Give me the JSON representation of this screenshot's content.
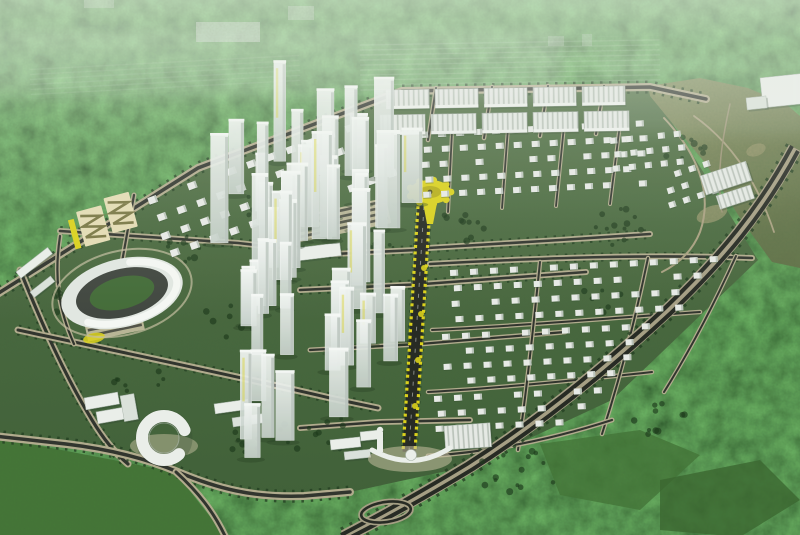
{
  "meta": {
    "description": "Aerial 3D master-plan rendering of a new urban township: central glass high-rise towers, villa grids, rowhouse blocks, oval stadium, yellow tree-lined boulevard, perimeter highway, surrounded by forest and fields",
    "width": 800,
    "height": 535
  },
  "colors": {
    "haze_top": "#93a28c",
    "forest_mid": "#34562c",
    "forest_dark": "#24441f",
    "field": "#3f7231",
    "field2": "#356329",
    "lawn_hi": "#4a6a3e",
    "lawn_lo": "#3c5c33",
    "hills_hi": "#878c5c",
    "hills_lo": "#66724616",
    "hills": "#6e7849",
    "sand": "#c2b083",
    "road_core": "#2b2e28",
    "road_casing": "#b2aa8c",
    "highway_core": "#20231d",
    "highway_casing": "#a59d82",
    "tree": "#1d3a1b",
    "tree2": "#163214",
    "white": "#eef1ed",
    "white_dim": "#dde3dd",
    "shade": "#aab5ac",
    "glass_hi": "#f6f9f7",
    "glass_lo": "#c8d2cc",
    "yellow": "#ddd215",
    "yellow_dark": "#b8ae10",
    "cream": "#e7deb5",
    "zigzag": "#77743f",
    "apron": "#c6bfa0",
    "track": "#3c413b",
    "infield": "#3f6833",
    "distant": "#cfd8cf",
    "haze": "#e9efe5"
  },
  "scene": {
    "dev_polygon": "-6,296 198,168 402,91 650,87 664,110 702,170 758,260 612,400 470,466 350,492 306,497 250,497 178,472 150,460 66,444 -6,436",
    "field_bl": "-6,437 175,472 226,537 -6,537",
    "bright_patch_1": "540,444 640,430 700,455 640,510 560,495",
    "bright_patch_2": "660,480 760,460 800,500 740,537 660,530",
    "hills_polygon": "648,86 700,78 748,88 786,104 800,116 800,268 772,262 740,218 706,164 668,118 650,96",
    "roads": [
      {
        "name": "top-boundary-road",
        "d": "M -6 296 L 198 168 L 402 91 L 650 87 L 706 99",
        "cw": 8,
        "kw": 3.5,
        "tree": 13
      },
      {
        "name": "left-boundary-road",
        "d": "M 20 270 C 42 324 64 374 92 420 C 104 440 116 454 128 464",
        "cw": 7,
        "kw": 3.2,
        "tree": 11
      },
      {
        "name": "bottom-road",
        "d": "M -6 436 L 66 444 C 116 450 150 460 178 472 C 216 488 252 498 304 496 L 350 492",
        "cw": 8,
        "kw": 3.5,
        "tree": 13
      },
      {
        "name": "bottom-branch-road",
        "d": "M 176 472 C 198 492 214 512 226 538",
        "cw": 7,
        "kw": 3
      },
      {
        "name": "center-road",
        "d": "M 18 330 C 120 352 228 374 330 398 L 378 408",
        "cw": 7,
        "kw": 3,
        "tree": 11
      },
      {
        "name": "north-cross-road",
        "d": "M 60 231 L 238 243 L 334 254 L 416 250",
        "cw": 6,
        "kw": 2.6,
        "tree": 10
      },
      {
        "name": "park-road",
        "d": "M 134 195 L 122 262",
        "cw": 5,
        "kw": 2.2
      },
      {
        "name": "stadium-road",
        "d": "M 60 236 C 54 276 58 308 74 344",
        "cw": 5,
        "kw": 2.2
      },
      {
        "name": "cross-street-1",
        "d": "M 428 248 L 560 240 L 650 234",
        "cw": 6,
        "kw": 2.6,
        "tree": 10
      },
      {
        "name": "cross-street-2",
        "d": "M 300 290 L 424 284 L 586 272",
        "cw": 6,
        "kw": 2.6,
        "tree": 10
      },
      {
        "name": "cross-street-3",
        "d": "M 310 350 L 420 344 L 565 332",
        "cw": 5,
        "kw": 2.2
      },
      {
        "name": "south-cross-road",
        "d": "M 300 428 L 380 422 L 470 420",
        "cw": 6,
        "kw": 2.6
      },
      {
        "name": "estate-c-top-street",
        "d": "M 430 264 C 540 258 650 254 752 258",
        "cw": 6,
        "kw": 2.6,
        "tree": 9
      },
      {
        "name": "estate-b-street-1",
        "d": "M 452 132 L 448 212",
        "cw": 4,
        "kw": 1.8
      },
      {
        "name": "estate-b-street-2",
        "d": "M 508 128 L 502 208",
        "cw": 4,
        "kw": 1.8
      },
      {
        "name": "estate-b-street-3",
        "d": "M 564 126 L 556 206",
        "cw": 4,
        "kw": 1.8
      },
      {
        "name": "estate-b-street-4",
        "d": "M 620 124 L 610 204",
        "cw": 4,
        "kw": 1.8
      },
      {
        "name": "estate-c-street-h1",
        "d": "M 432 330 C 520 326 610 318 700 312",
        "cw": 4.5,
        "kw": 2
      },
      {
        "name": "estate-c-street-h2",
        "d": "M 428 392 C 500 388 580 380 652 372",
        "cw": 4.5,
        "kw": 2
      },
      {
        "name": "estate-c-street-v1",
        "d": "M 540 262 C 534 320 528 380 518 450",
        "cw": 4.5,
        "kw": 2
      },
      {
        "name": "estate-c-street-v2",
        "d": "M 648 258 C 636 316 622 372 602 434",
        "cw": 4.5,
        "kw": 2
      },
      {
        "name": "estate-c-street-v3",
        "d": "M 736 256 C 716 300 694 344 664 392",
        "cw": 4.5,
        "kw": 2
      },
      {
        "name": "estate-c-bottom-street",
        "d": "M 428 456 C 490 452 550 440 612 420",
        "cw": 5,
        "kw": 2.2
      },
      {
        "name": "rowhouse-cross-1",
        "d": "M 436 88 L 428 140",
        "cw": 4.5,
        "kw": 2
      },
      {
        "name": "rowhouse-cross-2",
        "d": "M 492 87 L 484 138",
        "cw": 4.5,
        "kw": 2
      },
      {
        "name": "rowhouse-cross-3",
        "d": "M 548 86 L 540 136",
        "cw": 4.5,
        "kw": 2
      },
      {
        "name": "rowhouse-cross-4",
        "d": "M 604 86 L 596 134",
        "cw": 4.5,
        "kw": 2
      },
      {
        "name": "hill-path-1",
        "d": "M 664 118 C 696 152 714 192 700 232 C 692 252 678 264 662 272",
        "cw": 0,
        "kw": 2,
        "core": "#a89f7e"
      },
      {
        "name": "hill-path-2",
        "d": "M 694 116 C 728 140 756 178 774 232",
        "cw": 0,
        "kw": 1.8,
        "core": "#a89f7e"
      },
      {
        "name": "hill-path-3",
        "d": "M 730 104 C 722 140 716 176 722 212",
        "cw": 0,
        "kw": 1.5,
        "core": "#9a9172"
      }
    ],
    "highway": {
      "name": "perimeter-highway",
      "d": "M 795 148 C 762 210 722 258 668 310 C 612 362 542 420 470 466 C 424 494 384 516 344 537",
      "cores": [
        "M 792 146 C 759 208 719 256 665 308 C 609 360 539 418 467 464 C 421 492 381 514 341 535",
        "M 798 151 C 765 213 725 261 671 313 C 615 365 545 423 473 469 C 427 497 387 519 347 539"
      ],
      "casing_w": 14,
      "tree_w": 20
    },
    "avenue": {
      "name": "grand-boulevard",
      "base": "M 424 206 L 409 452",
      "yellow_left": "M 418 206 L 403 452",
      "yellow_right": "M 430 206 L 415 452",
      "roundabout": {
        "cx": 430,
        "cy": 192,
        "rx": 21,
        "ry": 12
      },
      "trunk": "423,203 437,203 433,224 427,224",
      "dots": [
        [
          424,
          268
        ],
        [
          421,
          314
        ],
        [
          418,
          360
        ],
        [
          415,
          406
        ]
      ]
    },
    "villa_estates": [
      {
        "name": "villa-grid-northwest",
        "x": 148,
        "y": 200,
        "rot": -20,
        "rows": 4,
        "cols": 12,
        "dx": 21,
        "dy": 19,
        "w": 9,
        "h": 7
      },
      {
        "name": "villa-grid-north",
        "x": 420,
        "y": 134,
        "rot": -3,
        "rows": 5,
        "cols": 13,
        "dx": 18,
        "dy": 15,
        "w": 8,
        "h": 6
      },
      {
        "name": "villa-grid-east-1",
        "x": 450,
        "y": 272,
        "rot": -3,
        "rows": 4,
        "cols": 15,
        "dx": 20,
        "dy": 15.5,
        "w": 8,
        "h": 6,
        "cut": true
      },
      {
        "name": "villa-grid-east-2",
        "x": 442,
        "y": 336,
        "rot": -3,
        "rows": 4,
        "cols": 12,
        "dx": 20,
        "dy": 15,
        "w": 8,
        "h": 6,
        "cut": true
      },
      {
        "name": "villa-grid-east-3",
        "x": 434,
        "y": 398,
        "rot": -3,
        "rows": 3,
        "cols": 9,
        "dx": 20,
        "dy": 15,
        "w": 8,
        "h": 6,
        "cut": true
      },
      {
        "name": "villa-grid-mid-east",
        "x": 610,
        "y": 140,
        "rot": -6,
        "rows": 3,
        "cols": 5,
        "dx": 16,
        "dy": 14,
        "w": 7,
        "h": 6
      },
      {
        "name": "villa-grid-far-east",
        "x": 660,
        "y": 178,
        "rot": -18,
        "rows": 3,
        "cols": 4,
        "dx": 15,
        "dy": 14,
        "w": 7,
        "h": 6
      }
    ],
    "rowhouse_bands": [
      {
        "name": "rowhouse-band-1",
        "x": 386,
        "y": 90,
        "rot": -1,
        "blocks": 5,
        "bw": 43,
        "bh": 19,
        "gap": 6
      },
      {
        "name": "rowhouse-band-2",
        "x": 380,
        "y": 115,
        "rot": -1,
        "blocks": 5,
        "bw": 45,
        "bh": 20,
        "gap": 6
      }
    ],
    "tower_clusters": [
      {
        "name": "tower-cluster-north",
        "x0": 190,
        "x1": 408,
        "y0": 158,
        "y1": 288,
        "n": 30,
        "hmin": 52,
        "hmax": 108,
        "wmin": 11,
        "wmax": 21,
        "seed": 11
      },
      {
        "name": "tower-cluster-south",
        "x0": 196,
        "x1": 414,
        "y0": 300,
        "y1": 458,
        "n": 24,
        "hmin": 44,
        "hmax": 92,
        "wmin": 10,
        "wmax": 19,
        "seed": 29
      }
    ],
    "landmark_towers": [
      {
        "x": 377,
        "y": 228,
        "w": 23,
        "h": 96
      },
      {
        "x": 352,
        "y": 282,
        "w": 18,
        "h": 92
      },
      {
        "x": 252,
        "y": 270,
        "w": 16,
        "h": 95
      }
    ],
    "misc_buildings": [
      {
        "name": "office-slab",
        "x": 84,
        "y": 398,
        "w": 34,
        "h": 12,
        "rot": -10,
        "fill": "white"
      },
      {
        "name": "office-slab",
        "x": 96,
        "y": 412,
        "w": 40,
        "h": 12,
        "rot": -10,
        "fill": "white"
      },
      {
        "name": "office-slab",
        "x": 120,
        "y": 396,
        "w": 14,
        "h": 26,
        "rot": -10,
        "fill": "dim"
      },
      {
        "name": "office-slab",
        "x": 214,
        "y": 404,
        "w": 34,
        "h": 10,
        "rot": -8,
        "fill": "white"
      },
      {
        "name": "office-slab",
        "x": 232,
        "y": 418,
        "w": 30,
        "h": 9,
        "rot": -8,
        "fill": "dim"
      },
      {
        "name": "plaza-west-building",
        "x": 330,
        "y": 440,
        "w": 30,
        "h": 10,
        "rot": -6,
        "fill": "white"
      },
      {
        "name": "plaza-west-building",
        "x": 344,
        "y": 452,
        "w": 26,
        "h": 8,
        "rot": -6,
        "fill": "dim"
      },
      {
        "name": "plaza-west-building",
        "x": 360,
        "y": 432,
        "w": 22,
        "h": 9,
        "rot": -6,
        "fill": "white"
      },
      {
        "name": "plaza-east-hall",
        "x": 444,
        "y": 426,
        "w": 46,
        "h": 24,
        "rot": -4,
        "fill": "ridge"
      },
      {
        "name": "east-campus-hall",
        "x": 700,
        "y": 176,
        "w": 48,
        "h": 20,
        "rot": -18,
        "fill": "ridge"
      },
      {
        "name": "east-campus-hall",
        "x": 716,
        "y": 196,
        "w": 36,
        "h": 14,
        "rot": -18,
        "fill": "ridge"
      },
      {
        "name": "northeast-hall",
        "x": 760,
        "y": 78,
        "w": 46,
        "h": 30,
        "rot": -6,
        "fill": "white"
      },
      {
        "name": "northeast-hall",
        "x": 746,
        "y": 98,
        "w": 20,
        "h": 12,
        "rot": -6,
        "fill": "dim"
      },
      {
        "name": "west-strip-building",
        "x": 16,
        "y": 272,
        "w": 40,
        "h": 8,
        "rot": -38,
        "fill": "white"
      },
      {
        "name": "west-strip-building",
        "x": 30,
        "y": 292,
        "w": 26,
        "h": 7,
        "rot": -38,
        "fill": "dim"
      },
      {
        "name": "curved-podium",
        "x": 296,
        "y": 248,
        "w": 44,
        "h": 13,
        "rot": -7,
        "fill": "white"
      }
    ],
    "distant_buildings": [
      {
        "x": 196,
        "y": 22,
        "w": 64,
        "h": 20,
        "op": 0.55
      },
      {
        "x": 288,
        "y": 6,
        "w": 26,
        "h": 14,
        "op": 0.4
      },
      {
        "x": 84,
        "y": 0,
        "w": 30,
        "h": 8,
        "op": 0.35
      },
      {
        "x": 548,
        "y": 36,
        "w": 16,
        "h": 10,
        "op": 0.3
      },
      {
        "x": 582,
        "y": 34,
        "w": 10,
        "h": 12,
        "op": 0.3
      }
    ],
    "stadium": {
      "name": "stadium",
      "cx": 122,
      "cy": 293,
      "rot": -14,
      "orx": 62,
      "ory": 34,
      "trx": 47,
      "try": 24,
      "irx": 33,
      "iry": 16
    },
    "parking_lots": [
      {
        "name": "parking-lot-central",
        "x": 290,
        "y": 218,
        "w": 98,
        "h": 26,
        "rot": -12,
        "rows": 4
      },
      {
        "name": "parking-lot-stadium",
        "x": 84,
        "y": 322,
        "w": 58,
        "h": 20,
        "rot": -12,
        "rows": 3
      }
    ],
    "zigzag_park": {
      "name": "zigzag-garden",
      "x": 76,
      "y": 212,
      "rot": -15
    },
    "yellow_oval": {
      "cx": 94,
      "cy": 338,
      "rx": 11,
      "ry": 5,
      "rot": -12
    },
    "c_building": {
      "name": "horseshoe-building",
      "cx": 164,
      "cy": 438,
      "r": 22
    },
    "plaza": {
      "name": "gateway-plaza",
      "arc": "M 372 450 Q 412 472 450 448",
      "dome": [
        411,
        455
      ],
      "apron": [
        410,
        459,
        42,
        13
      ],
      "monument": [
        377,
        432,
        6,
        20
      ]
    },
    "loop": {
      "name": "interchange-loop",
      "cx": 386,
      "cy": 512,
      "rx": 25,
      "ry": 10,
      "rot": -8
    },
    "tree_clusters": [
      {
        "x": 300,
        "y": 210,
        "r": 60,
        "n": 26
      },
      {
        "x": 360,
        "y": 240,
        "r": 40,
        "n": 14
      },
      {
        "x": 455,
        "y": 230,
        "r": 30,
        "n": 10
      },
      {
        "x": 620,
        "y": 225,
        "r": 35,
        "n": 12
      },
      {
        "x": 680,
        "y": 148,
        "r": 25,
        "n": 8
      },
      {
        "x": 230,
        "y": 320,
        "r": 30,
        "n": 10
      },
      {
        "x": 180,
        "y": 250,
        "r": 25,
        "n": 8
      },
      {
        "x": 320,
        "y": 430,
        "r": 40,
        "n": 12
      },
      {
        "x": 520,
        "y": 470,
        "r": 45,
        "n": 14
      },
      {
        "x": 600,
        "y": 300,
        "r": 25,
        "n": 8
      },
      {
        "x": 60,
        "y": 300,
        "r": 22,
        "n": 8
      },
      {
        "x": 140,
        "y": 380,
        "r": 26,
        "n": 8
      },
      {
        "x": 250,
        "y": 440,
        "r": 24,
        "n": 8
      },
      {
        "x": 660,
        "y": 420,
        "r": 30,
        "n": 10
      }
    ],
    "sand_patches": [
      {
        "cx": 712,
        "cy": 214,
        "rx": 16,
        "ry": 8,
        "rot": -20,
        "op": 0.5
      },
      {
        "cx": 756,
        "cy": 150,
        "rx": 10,
        "ry": 6,
        "rot": -20,
        "op": 0.35
      }
    ]
  }
}
